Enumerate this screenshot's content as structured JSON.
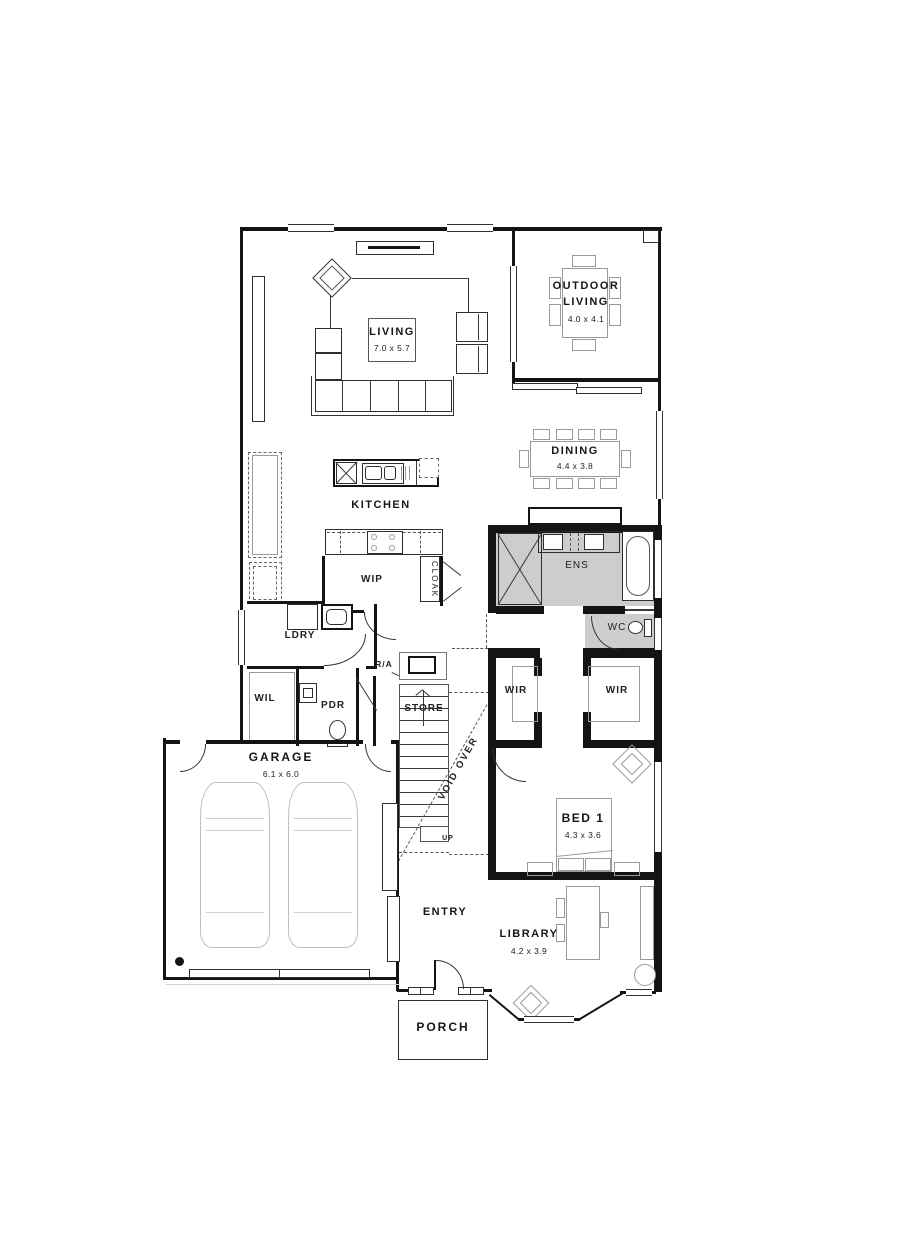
{
  "plan": {
    "colors": {
      "wall": "#141414",
      "wet_area_fill": "#cdcdcd",
      "furniture_line": "#9a9a9a",
      "accent_line": "#333333"
    },
    "rooms": {
      "living": {
        "label": "LIVING",
        "dims": "7.0 x 5.7"
      },
      "outdoor_living": {
        "label_line1": "OUTDOOR",
        "label_line2": "LIVING",
        "dims": "4.0 x 4.1"
      },
      "dining": {
        "label": "DINING",
        "dims": "4.4 x 3.8"
      },
      "kitchen": {
        "label": "KITCHEN"
      },
      "wip": {
        "label": "WIP"
      },
      "cloak": {
        "label": "CLOAK"
      },
      "ldry": {
        "label": "LDRY"
      },
      "wil": {
        "label": "WIL"
      },
      "pdr": {
        "label": "PDR"
      },
      "return_air": {
        "label": "R/A"
      },
      "store": {
        "label": "STORE"
      },
      "stairs": {
        "up_label": "UP"
      },
      "void": {
        "label": "VOID OVER"
      },
      "ens": {
        "label": "ENS"
      },
      "wc": {
        "label": "WC"
      },
      "wir_left": {
        "label": "WIR"
      },
      "wir_right": {
        "label": "WIR"
      },
      "bed1": {
        "label": "BED 1",
        "dims": "4.3 x 3.6"
      },
      "garage": {
        "label": "GARAGE",
        "dims": "6.1 x 6.0"
      },
      "entry": {
        "label": "ENTRY"
      },
      "library": {
        "label": "LIBRARY",
        "dims": "4.2 x 3.9"
      },
      "porch": {
        "label": "PORCH"
      }
    }
  }
}
